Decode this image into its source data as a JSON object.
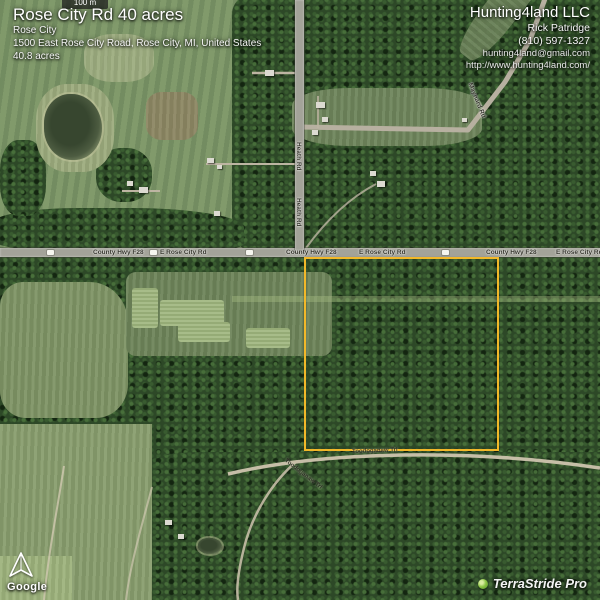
{
  "property": {
    "title": "Rose City Rd 40 acres",
    "city": "Rose City",
    "address": "1500 East Rose City Road, Rose City, MI, United States",
    "acres": "40.8 acres"
  },
  "contact": {
    "company": "Hunting4land LLC",
    "name": "Rick Patridge",
    "phone": "(810) 597-1327",
    "email": "hunting4land@gmail.com",
    "website": "http://www.hunting4land.com/"
  },
  "map": {
    "scale_label": "100 m",
    "attribution": "Google",
    "branding": "TerraStride Pro",
    "boundary_color": "#f2b829",
    "road_labels": [
      {
        "text": "County Hwy F28"
      },
      {
        "text": "E Rose City Rd"
      },
      {
        "text": "County Hwy F28"
      },
      {
        "text": "E Rose City Rd"
      },
      {
        "text": "County Hwy F28"
      },
      {
        "text": "E Rose City Rd"
      },
      {
        "text": "Heath Rd"
      },
      {
        "text": "Heath Rd"
      },
      {
        "text": "Maynard Rd"
      },
      {
        "text": "Toodoganaw Trl"
      },
      {
        "text": "Toodoganaw Trl"
      }
    ]
  }
}
